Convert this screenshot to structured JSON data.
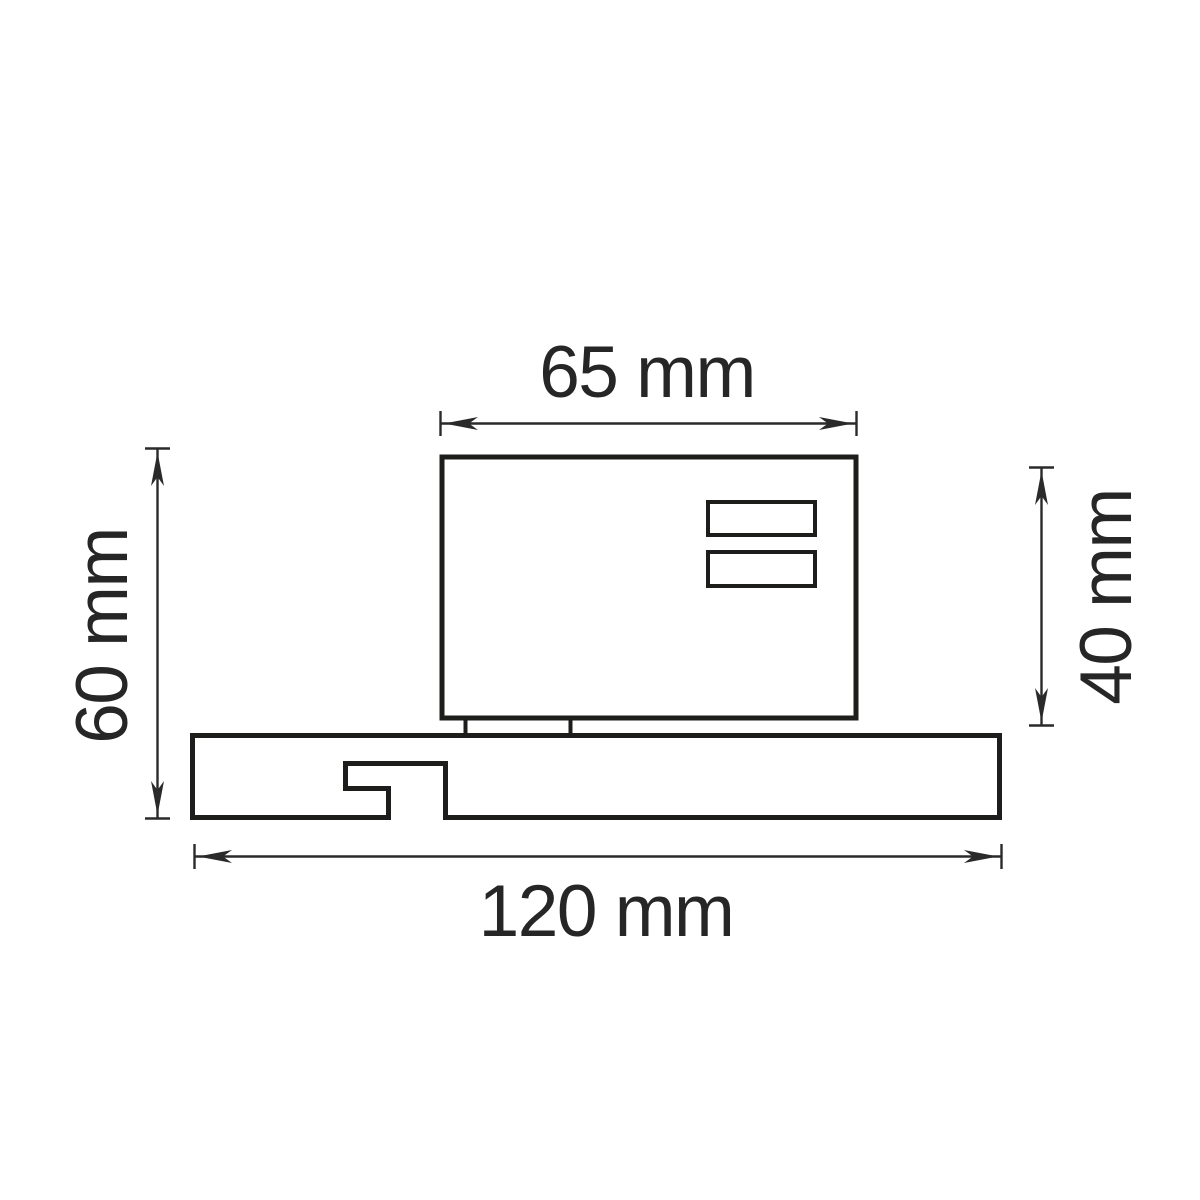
{
  "drawing": {
    "kind": "technical-dimension-drawing",
    "background_color": "#ffffff",
    "line_color": "#1d1d1b",
    "dimension_color": "#2a2a2a",
    "labels": {
      "top_width": "65 mm",
      "left_height": "60 mm",
      "right_height": "40 mm",
      "bottom_width": "120 mm"
    },
    "values": {
      "top_width_mm": 65,
      "left_height_mm": 60,
      "right_height_mm": 40,
      "bottom_width_mm": 120
    }
  }
}
